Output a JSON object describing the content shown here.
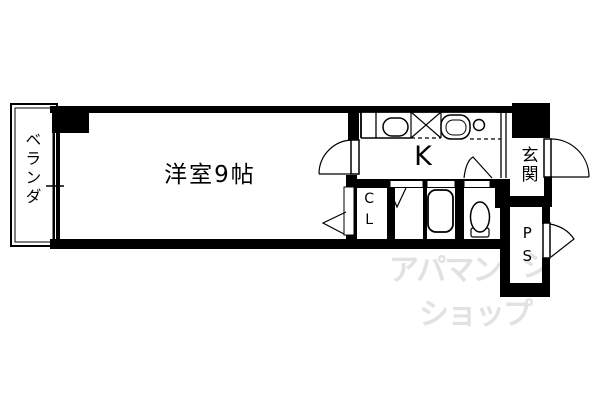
{
  "plan": {
    "type": "apartment-floor-plan",
    "rooms": {
      "western_room": {
        "label": "洋室9帖"
      },
      "kitchen": {
        "label": "K"
      },
      "entrance": {
        "label": "玄関"
      },
      "closet": {
        "label": "CL"
      },
      "pipe_space": {
        "label": "PS"
      },
      "balcony": {
        "label": "ベランダ"
      }
    },
    "colors": {
      "line": "#000000",
      "background": "#ffffff",
      "watermark": "#e2e2e2"
    }
  },
  "watermark": {
    "line1": "アパマン",
    "line2": "ショップ",
    "mark": "ジ"
  }
}
